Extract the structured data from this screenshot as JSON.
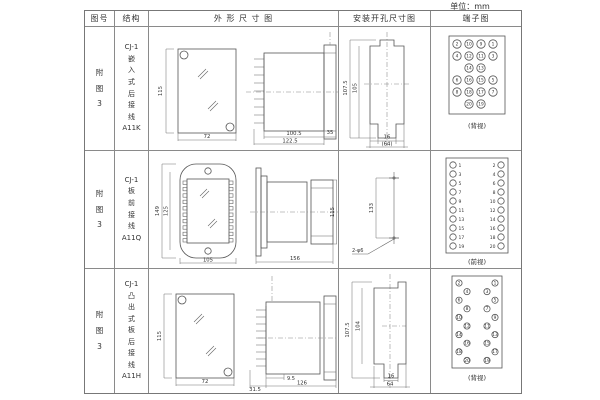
{
  "unit_label": "单位：mm",
  "colors": {
    "line": "#555555",
    "border": "#8a8a8a",
    "text": "#333333"
  },
  "table": {
    "headers": {
      "figure": "图号",
      "structure": "结构",
      "outline": "外 形 尺 寸 图",
      "install": "安装开孔尺寸图",
      "terminal": "端子图"
    },
    "rows": [
      {
        "figure_no": "附\n图\n3",
        "structure": "CJ-1\n嵌\n入\n式\n后\n接\n线\nA11K",
        "outline_dims": {
          "front_h": "115",
          "front_w": "72",
          "side_a": "100.5",
          "side_b": "122.5",
          "side_c": "35"
        },
        "install_dims": {
          "outer_h": "107.5",
          "inner_h": "105",
          "slot_w": "16",
          "overall_w": "(64)"
        },
        "terminal": {
          "caption": "(背视)",
          "rows": [
            [
              "2",
              "10",
              "9",
              "1"
            ],
            [
              "4",
              "12",
              "11",
              "3"
            ],
            [
              "14",
              "13"
            ],
            [
              "6",
              "16",
              "15",
              "5"
            ],
            [
              "8",
              "18",
              "17",
              "7"
            ],
            [
              "20",
              "19"
            ]
          ]
        }
      },
      {
        "figure_no": "附\n图\n3",
        "structure": "CJ-1\n板\n前\n接\n线\nA11Q",
        "outline_dims": {
          "front_h": "149",
          "front_h2": "125",
          "front_w": "105",
          "side_w": "156",
          "side_h": "115"
        },
        "install_dims": {
          "height": "133",
          "holes": "2-φ6"
        },
        "terminal": {
          "caption": "(前视)",
          "left": [
            "1",
            "3",
            "5",
            "7",
            "9",
            "11",
            "13",
            "15",
            "17",
            "19"
          ],
          "right": [
            "2",
            "4",
            "6",
            "8",
            "10",
            "12",
            "14",
            "16",
            "18",
            "20"
          ]
        }
      },
      {
        "figure_no": "附\n图\n3",
        "structure": "CJ-1\n凸\n出\n式\n板\n后\n接\n线\nA11H",
        "outline_dims": {
          "front_h": "115",
          "front_w": "72",
          "side_a": "31.5",
          "side_b": "9.5",
          "side_c": "126"
        },
        "install_dims": {
          "outer_h": "107.5",
          "inner_h": "104",
          "slot_w": "16",
          "overall_w": "64"
        },
        "terminal": {
          "caption": "(背视)",
          "left": [
            "2",
            "4",
            "6",
            "8",
            "10",
            "12",
            "14",
            "16",
            "18",
            "20"
          ],
          "right": [
            "1",
            "3",
            "5",
            "7",
            "9",
            "11",
            "13",
            "15",
            "17",
            "19"
          ]
        }
      }
    ]
  }
}
